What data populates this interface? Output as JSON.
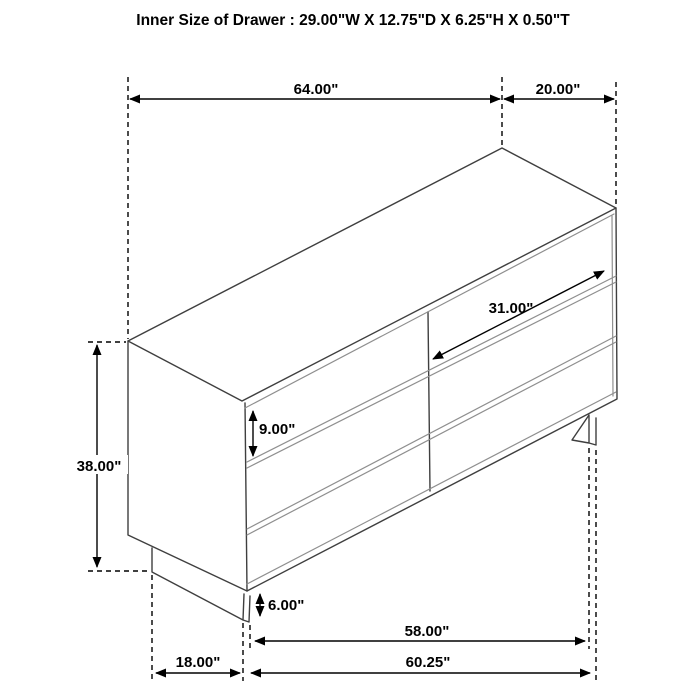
{
  "title": "Inner Size of Drawer : 29.00\"W X 12.75\"D X 6.25\"H X 0.50\"T",
  "product": "six-drawer-dresser-dimension-diagram",
  "dimensions": {
    "top_width": "64.00\"",
    "top_depth": "20.00\"",
    "overall_height": "38.00\"",
    "drawer_front_width": "31.00\"",
    "drawer_front_height": "9.00\"",
    "base_height": "6.00\"",
    "leg_span": "58.00\"",
    "base_width": "60.25\"",
    "base_depth": "18.00\""
  },
  "colors": {
    "background": "#ffffff",
    "dimension_lines": "#000000",
    "furniture_outline": "#3f3f3f",
    "drawer_rails": "#8f8f8f",
    "text": "#000000"
  }
}
